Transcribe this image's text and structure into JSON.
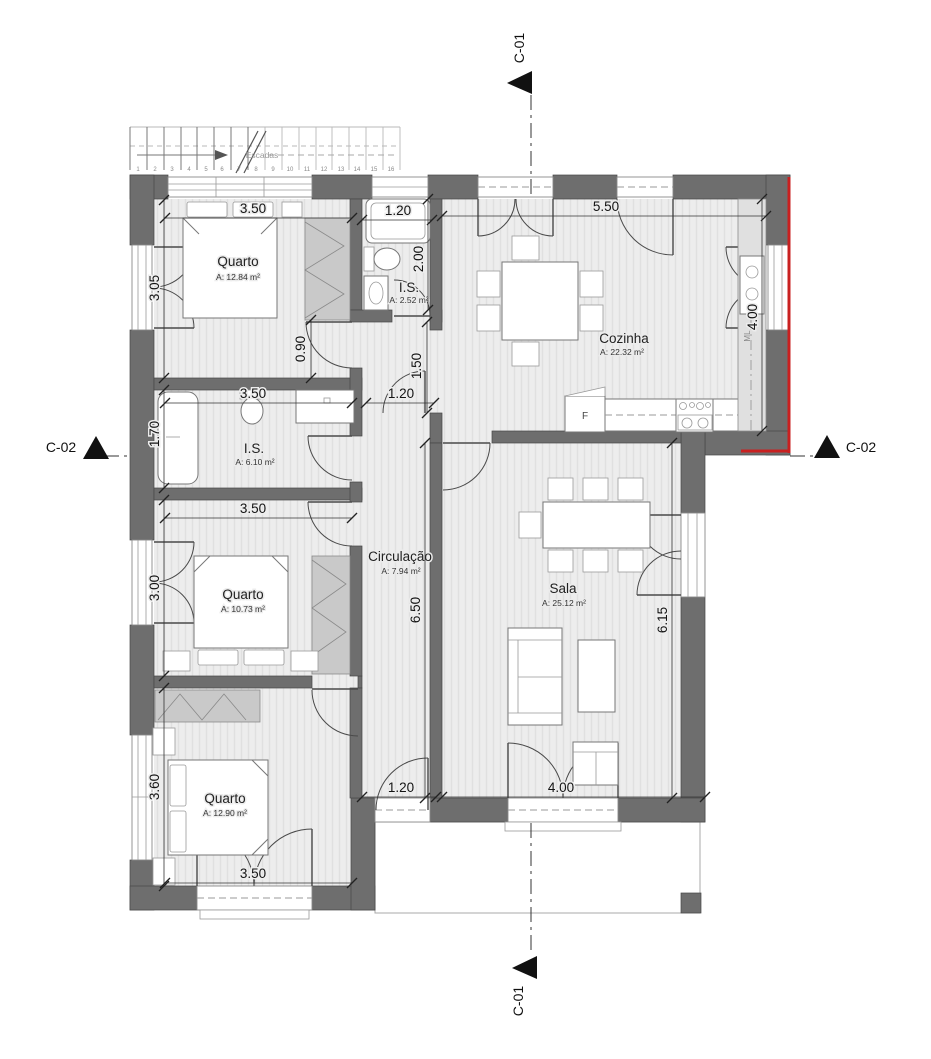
{
  "plan": {
    "rooms": {
      "quarto1": {
        "name": "Quarto",
        "area": "A: 12.84 m²"
      },
      "is1": {
        "name": "I.S.",
        "area": "A: 2.52 m²"
      },
      "cozinha": {
        "name": "Cozinha",
        "area": "A: 22.32 m²"
      },
      "is2": {
        "name": "I.S.",
        "area": "A: 6.10 m²"
      },
      "quarto2": {
        "name": "Quarto",
        "area": "A: 10.73 m²"
      },
      "circulacao": {
        "name": "Circulação",
        "area": "A: 7.94 m²"
      },
      "sala": {
        "name": "Sala",
        "area": "A: 25.12 m²"
      },
      "quarto3": {
        "name": "Quarto",
        "area": "A: 12.90 m²"
      }
    },
    "dims": {
      "w_quarto1": "3.50",
      "w_is1": "1.20",
      "w_cozinha": "5.50",
      "h_quarto1": "3.05",
      "h_is1": "2.00",
      "h_pass": "0.90",
      "h_hall": "1.50",
      "h_cozinha": "4.00",
      "w_is2": "3.50",
      "w_hall": "1.20",
      "h_is2": "1.70",
      "w_quarto2": "3.50",
      "h_quarto2": "3.00",
      "h_circ": "6.50",
      "h_sala": "6.15",
      "h_quarto3": "3.60",
      "w_entry": "1.20",
      "w_sala": "4.00",
      "w_quarto3": "3.50"
    },
    "sections": {
      "c01": "C-01",
      "c02": "C-02"
    },
    "stairs": {
      "label": "Escadas",
      "steps": [
        "1",
        "2",
        "3",
        "4",
        "5",
        "6",
        "7",
        "8",
        "9",
        "10",
        "11",
        "12",
        "13",
        "14",
        "15",
        "16"
      ]
    },
    "appliances": {
      "fridge": "F",
      "washer": "ML"
    },
    "colors": {
      "wall": "#6e6e6e",
      "red_marker": "#c92020",
      "floor": "#ededed",
      "wardrobe": "#c9c9c9"
    }
  }
}
